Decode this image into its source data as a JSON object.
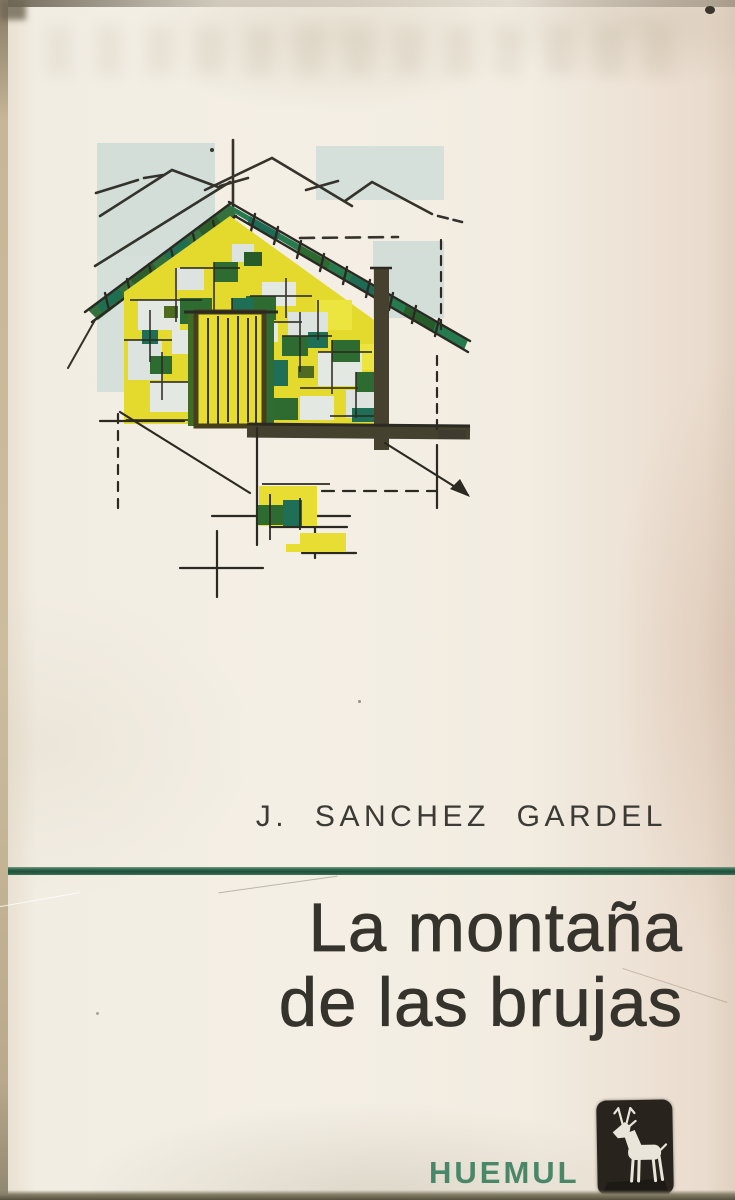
{
  "cover": {
    "author": "J. SANCHEZ GARDEL",
    "title": {
      "line1": "La montaña",
      "line2": "de las brujas"
    },
    "publisher": {
      "name": "HUEMUL",
      "logo_icon": "huemul-deer-logo"
    },
    "illustration_description": "sketch of mountain cabin in yellow, green and teal"
  },
  "colors": {
    "paper": "#f1ece2",
    "ink": "#36322c",
    "divider_green": "#2f6a50",
    "publisher_green": "#4a8768",
    "illustration_yellow": "#e4da2e",
    "illustration_green": "#2e6b31",
    "illustration_teal": "#1e6f55",
    "wash_blue_gray": "#d3ded9",
    "logo_background": "#28241d"
  }
}
